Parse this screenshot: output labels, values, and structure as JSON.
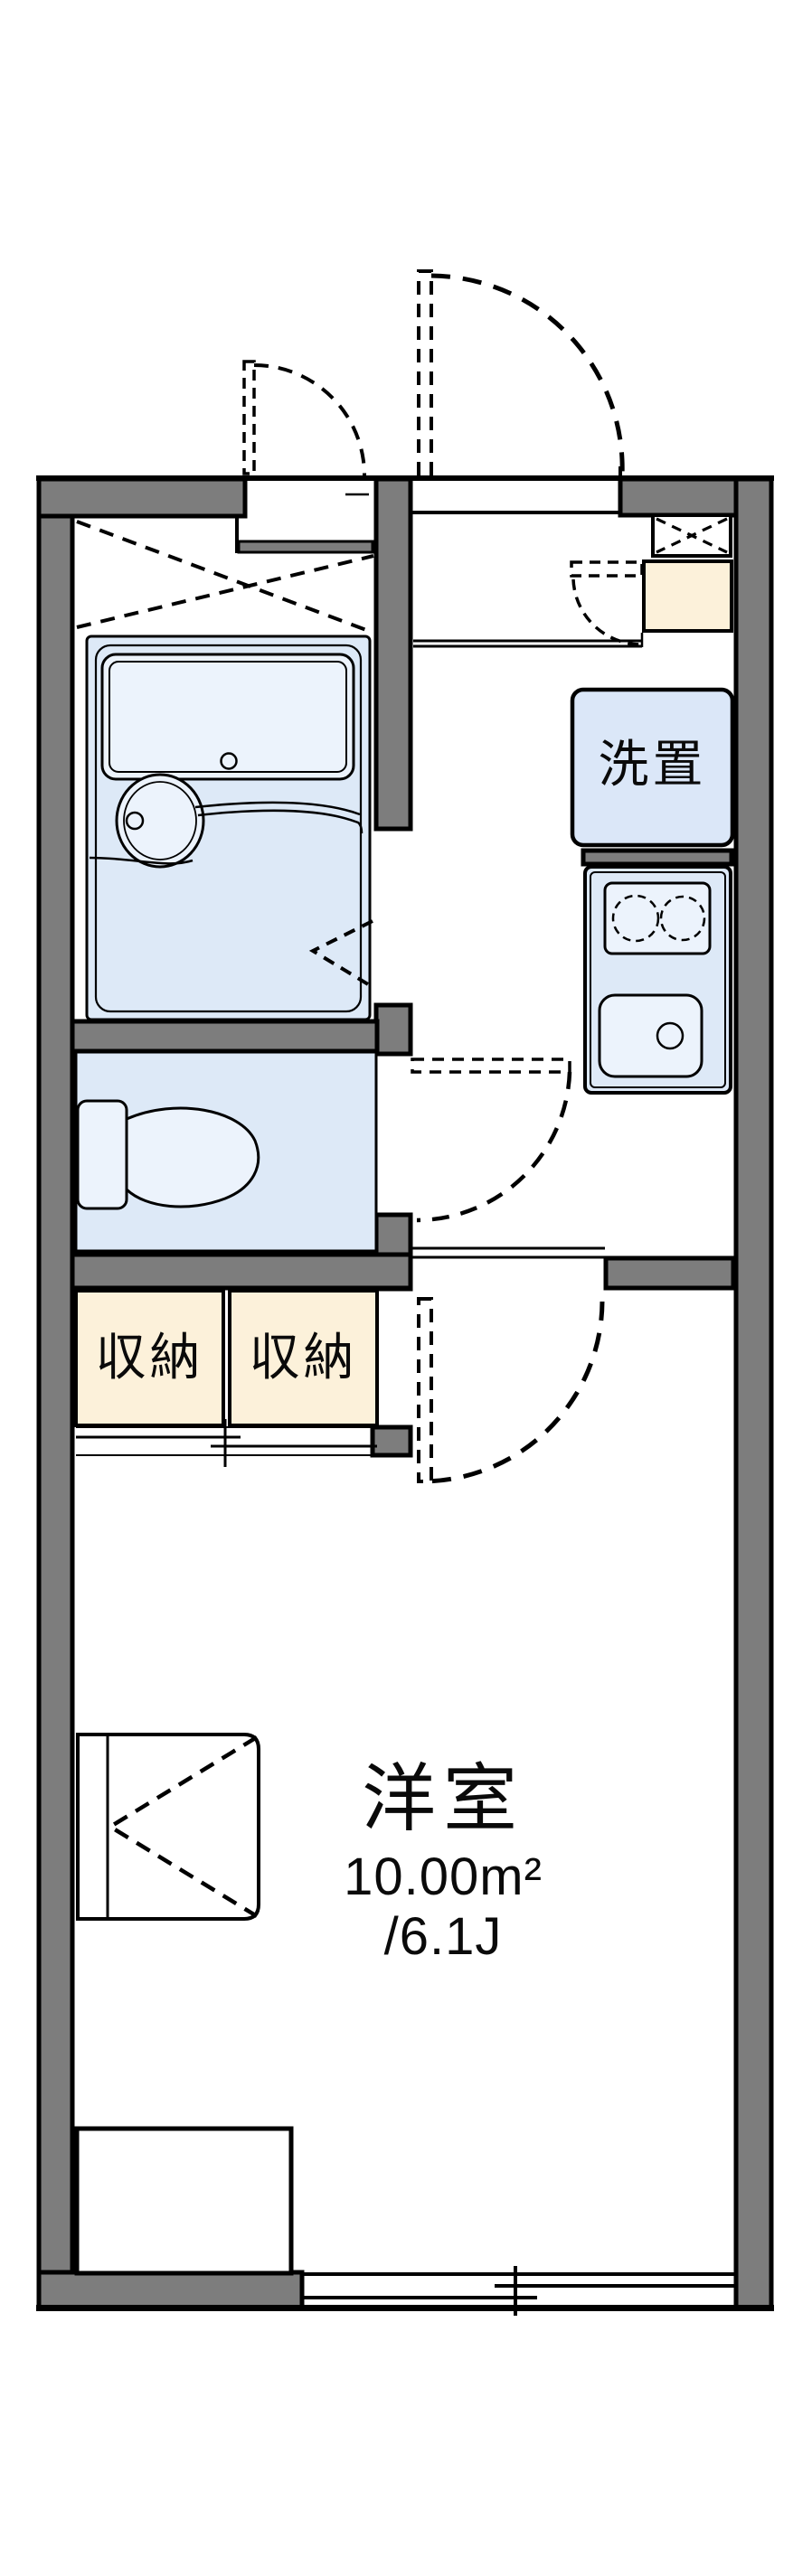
{
  "floor_plan": {
    "type": "japanese-apartment-floor-plan",
    "rooms": {
      "western_room": {
        "name": "洋室",
        "area_sqm": "10.00m²",
        "area_tatami": "/6.1J"
      },
      "storage_closets": [
        {
          "label": "収納"
        },
        {
          "label": "収納"
        }
      ],
      "washer_space": {
        "label": "洗置"
      }
    },
    "fixture_icons": [
      "unit-bath-with-bathtub-and-washbasin",
      "bath-folding-door",
      "overhead-shelf-dashed-x",
      "toilet-with-tank",
      "toilet-door-swing",
      "kitchen-counter-two-burner-stove-and-sink",
      "shoe-cabinet",
      "cabinet-door-swing",
      "vent-pipe-space-box",
      "entrance-door-swing",
      "service-niche-door-swing",
      "room-door-swing",
      "closet-sliding-doors",
      "desk-unit",
      "floor-step",
      "sliding-window"
    ],
    "colors": {
      "wall_fill": "#7d7d7d",
      "outline": "#000000",
      "water_area_fill": "#dde9f7",
      "fixture_fill": "#ecf3fc",
      "storage_fill": "#fcf1da",
      "background": "#ffffff"
    }
  }
}
